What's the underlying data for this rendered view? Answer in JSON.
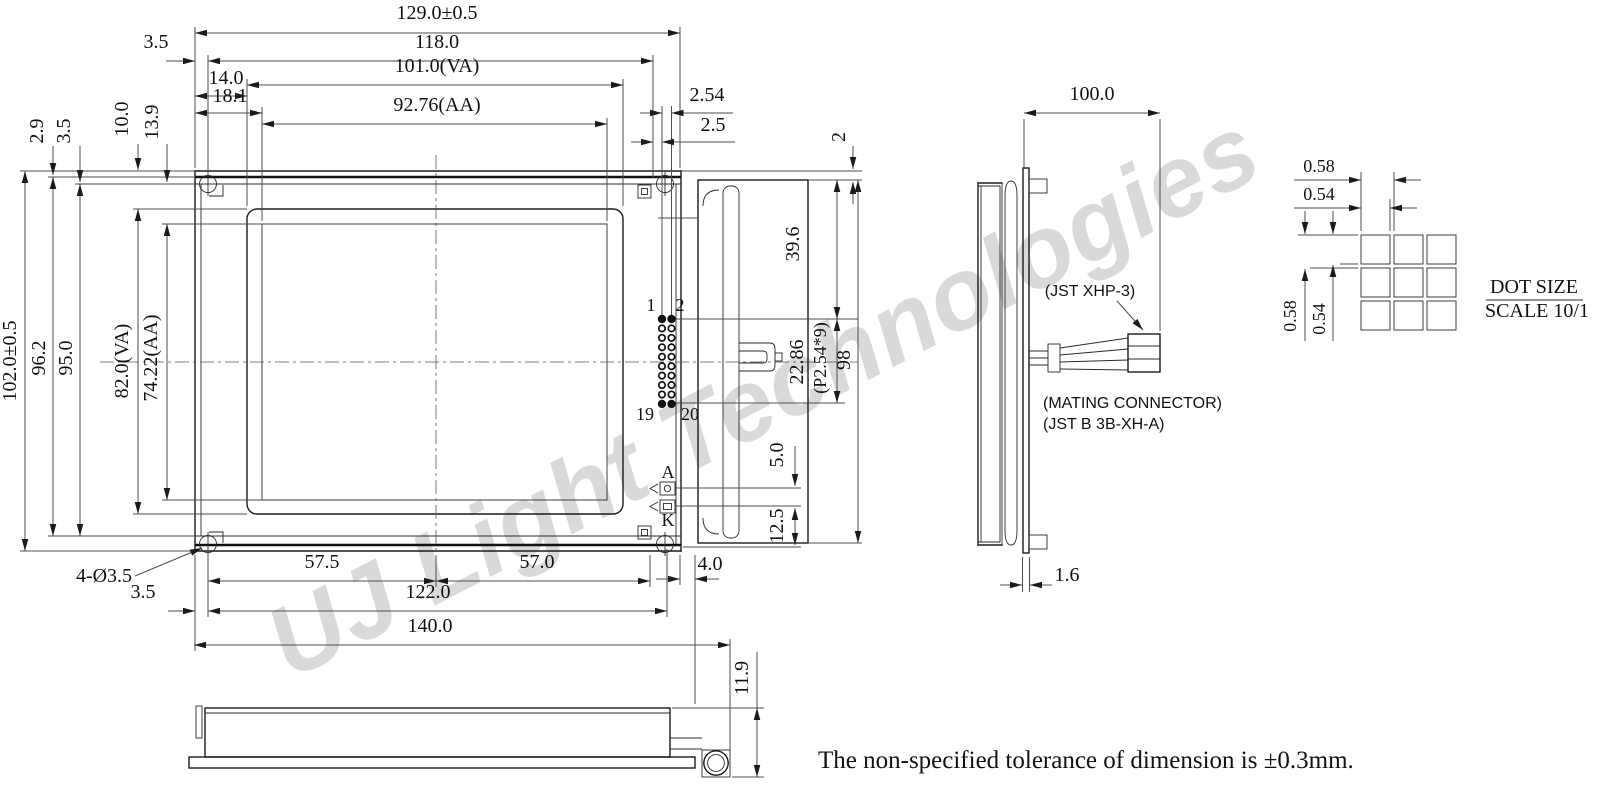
{
  "colors": {
    "line": "#1b1b1b",
    "dim": "#4d4d4d",
    "watermark": "#d9d9d9",
    "background": "#ffffff"
  },
  "watermark": {
    "text": "UJ Light Technologies"
  },
  "note": {
    "text": "The non-specified tolerance of dimension is ±0.3mm."
  },
  "front": {
    "top_dims": {
      "overall": "129.0±0.5",
      "board": "118.0",
      "edge_offset": "3.5",
      "va_offset": "14.0",
      "aa_offset": "18.1",
      "va": "101.0(VA)",
      "aa": "92.76(AA)",
      "pin_pitch": "2.54",
      "pin_edge": "2.5"
    },
    "left_dims": {
      "overall": "102.0±0.5",
      "frame": "96.2",
      "inner": "95.0",
      "va": "82.0(VA)",
      "aa": "74.22(AA)",
      "lip": "2.9",
      "lip2": "3.5",
      "va_offset": "10.0",
      "aa_offset": "13.9"
    },
    "bottom_dims": {
      "holes": "4-Ø3.5",
      "left_span": "57.5",
      "right_span": "57.0",
      "hole_span": "122.0",
      "edge_offset": "3.5",
      "overall": "140.0",
      "tab": "4.0"
    },
    "connector": {
      "rows": 10,
      "cols": 2,
      "x": 662,
      "y": 319,
      "pitch_x": 9.5,
      "pitch_y": 9.44,
      "pin1": "1",
      "pin2": "2",
      "pin19": "19",
      "pin20": "20"
    },
    "backlight": {
      "anode": "A",
      "cathode": "K"
    }
  },
  "profile": {
    "dims": {
      "top": "39.6",
      "pins": "22.86",
      "pitch_note": "(P2.54*9)",
      "overall": "98",
      "lip": "2",
      "led": "5.0",
      "led_edge": "12.5"
    }
  },
  "cable_view": {
    "dims": {
      "cable": "100.0",
      "pcb": "1.6"
    },
    "labels": {
      "connector": "(JST XHP-3)",
      "mating1": "(MATING CONNECTOR)",
      "mating2": "(JST B 3B-XH-A)"
    }
  },
  "bottom_view": {
    "dims": {
      "height": "11.9"
    }
  },
  "dot_detail": {
    "grid": {
      "rows": 3,
      "cols": 3,
      "x": 1361,
      "y": 235,
      "cell": 29,
      "pitch": 33
    },
    "dims": {
      "h_pitch": "0.58",
      "h_dot": "0.54",
      "v_pitch": "0.58",
      "v_dot": "0.54"
    },
    "title1": "DOT SIZE",
    "title2": "SCALE 10/1"
  }
}
